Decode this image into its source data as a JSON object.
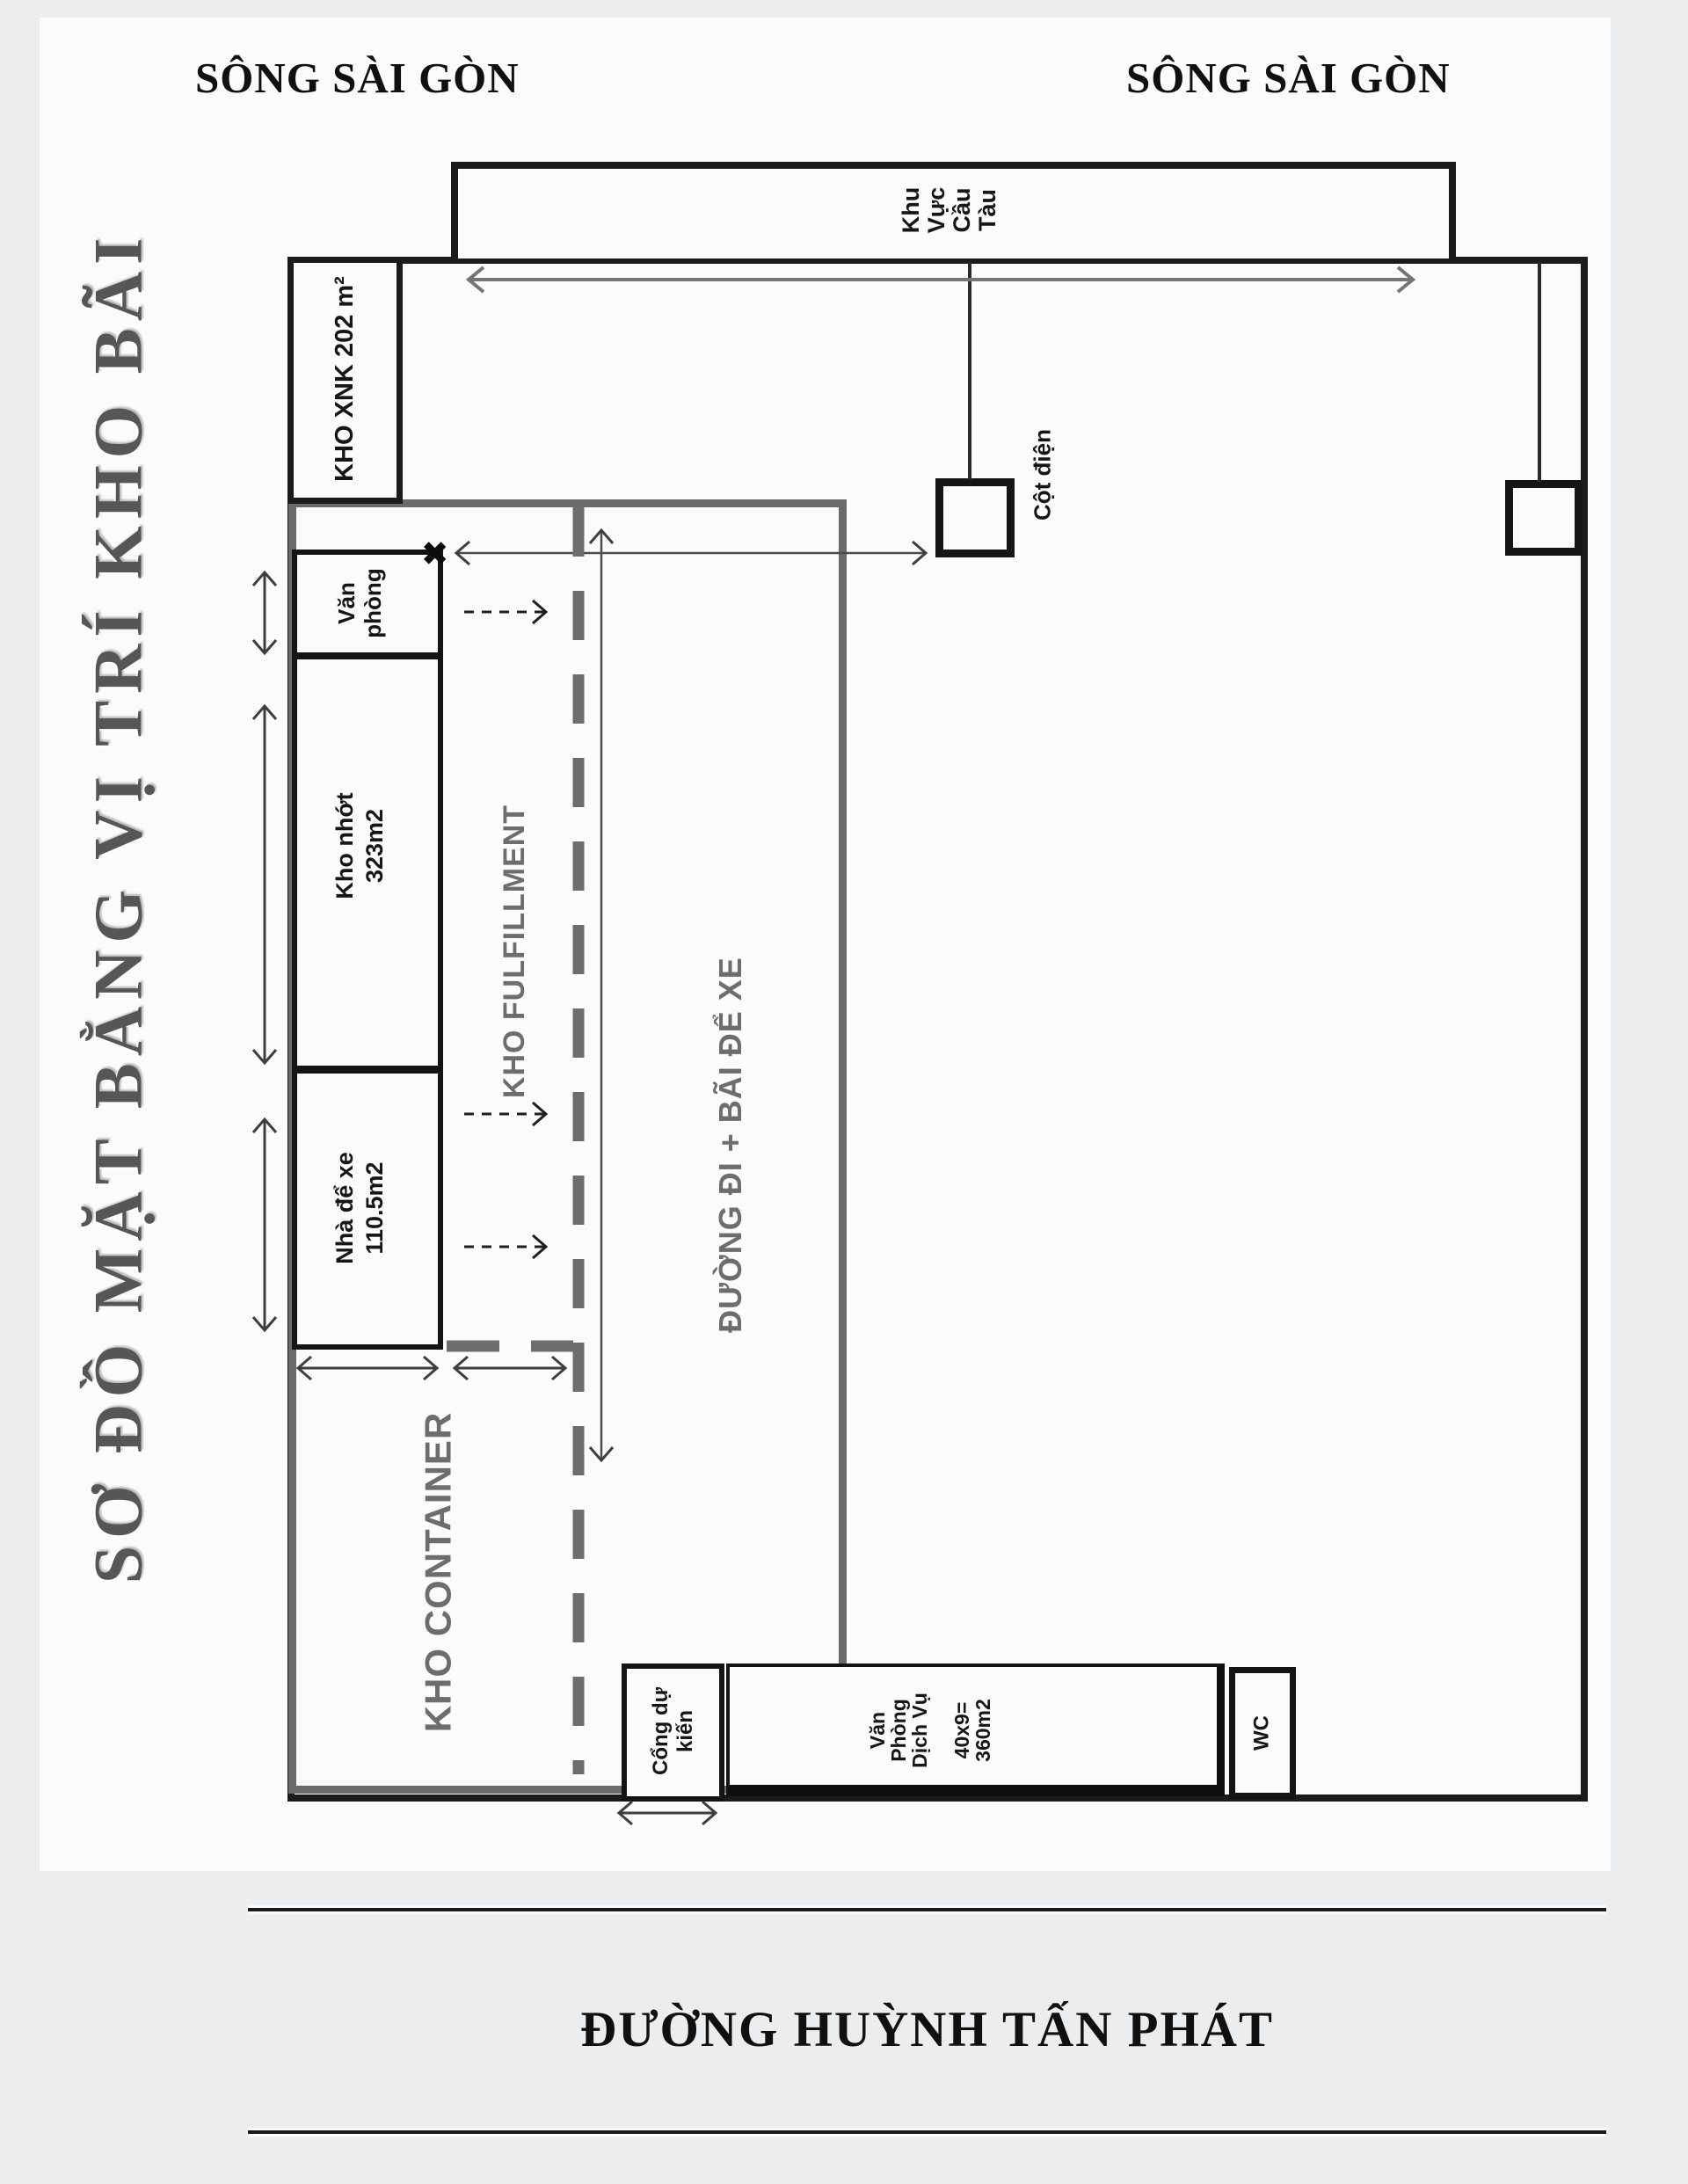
{
  "title": {
    "text": "SƠ ĐỒ MẶT BẰNG VỊ TRÍ KHO BÃI"
  },
  "rivers": {
    "left": "SÔNG SÀI GÒN",
    "right": "SÔNG SÀI GÒN"
  },
  "road": {
    "text": "ĐƯỜNG HUỲNH TẤN PHÁT"
  },
  "plan": {
    "cau_tau": "Khu\nVực\nCầu\nTàu",
    "kho_xnk": "KHO XNK 202 m²",
    "van_phong": "Văn\nphòng",
    "kho_nhot": "Kho nhớt\n323m2",
    "nha_de_xe": "Nhà để xe\n110.5m2",
    "kho_fulfillment": "KHO FULFILLMENT",
    "duong_di": "ĐƯỜNG ĐI + BÃI ĐỂ XE",
    "kho_container": "KHO CONTAINER",
    "cong_du_kien": "Cổng dự\nkiến",
    "van_phong_dich_vu": "Văn\nPhòng\nDịch Vụ\n \n40x9=\n360m2",
    "wc": "WC",
    "cot_dien": "Cột điện",
    "x_marker": "✖"
  },
  "colors": {
    "line_black": "#1a1a1a",
    "diagram_gray": "#6d6d6d",
    "title_gray": "#565656",
    "background": "#ecedee",
    "page": "#fbfbfc"
  }
}
